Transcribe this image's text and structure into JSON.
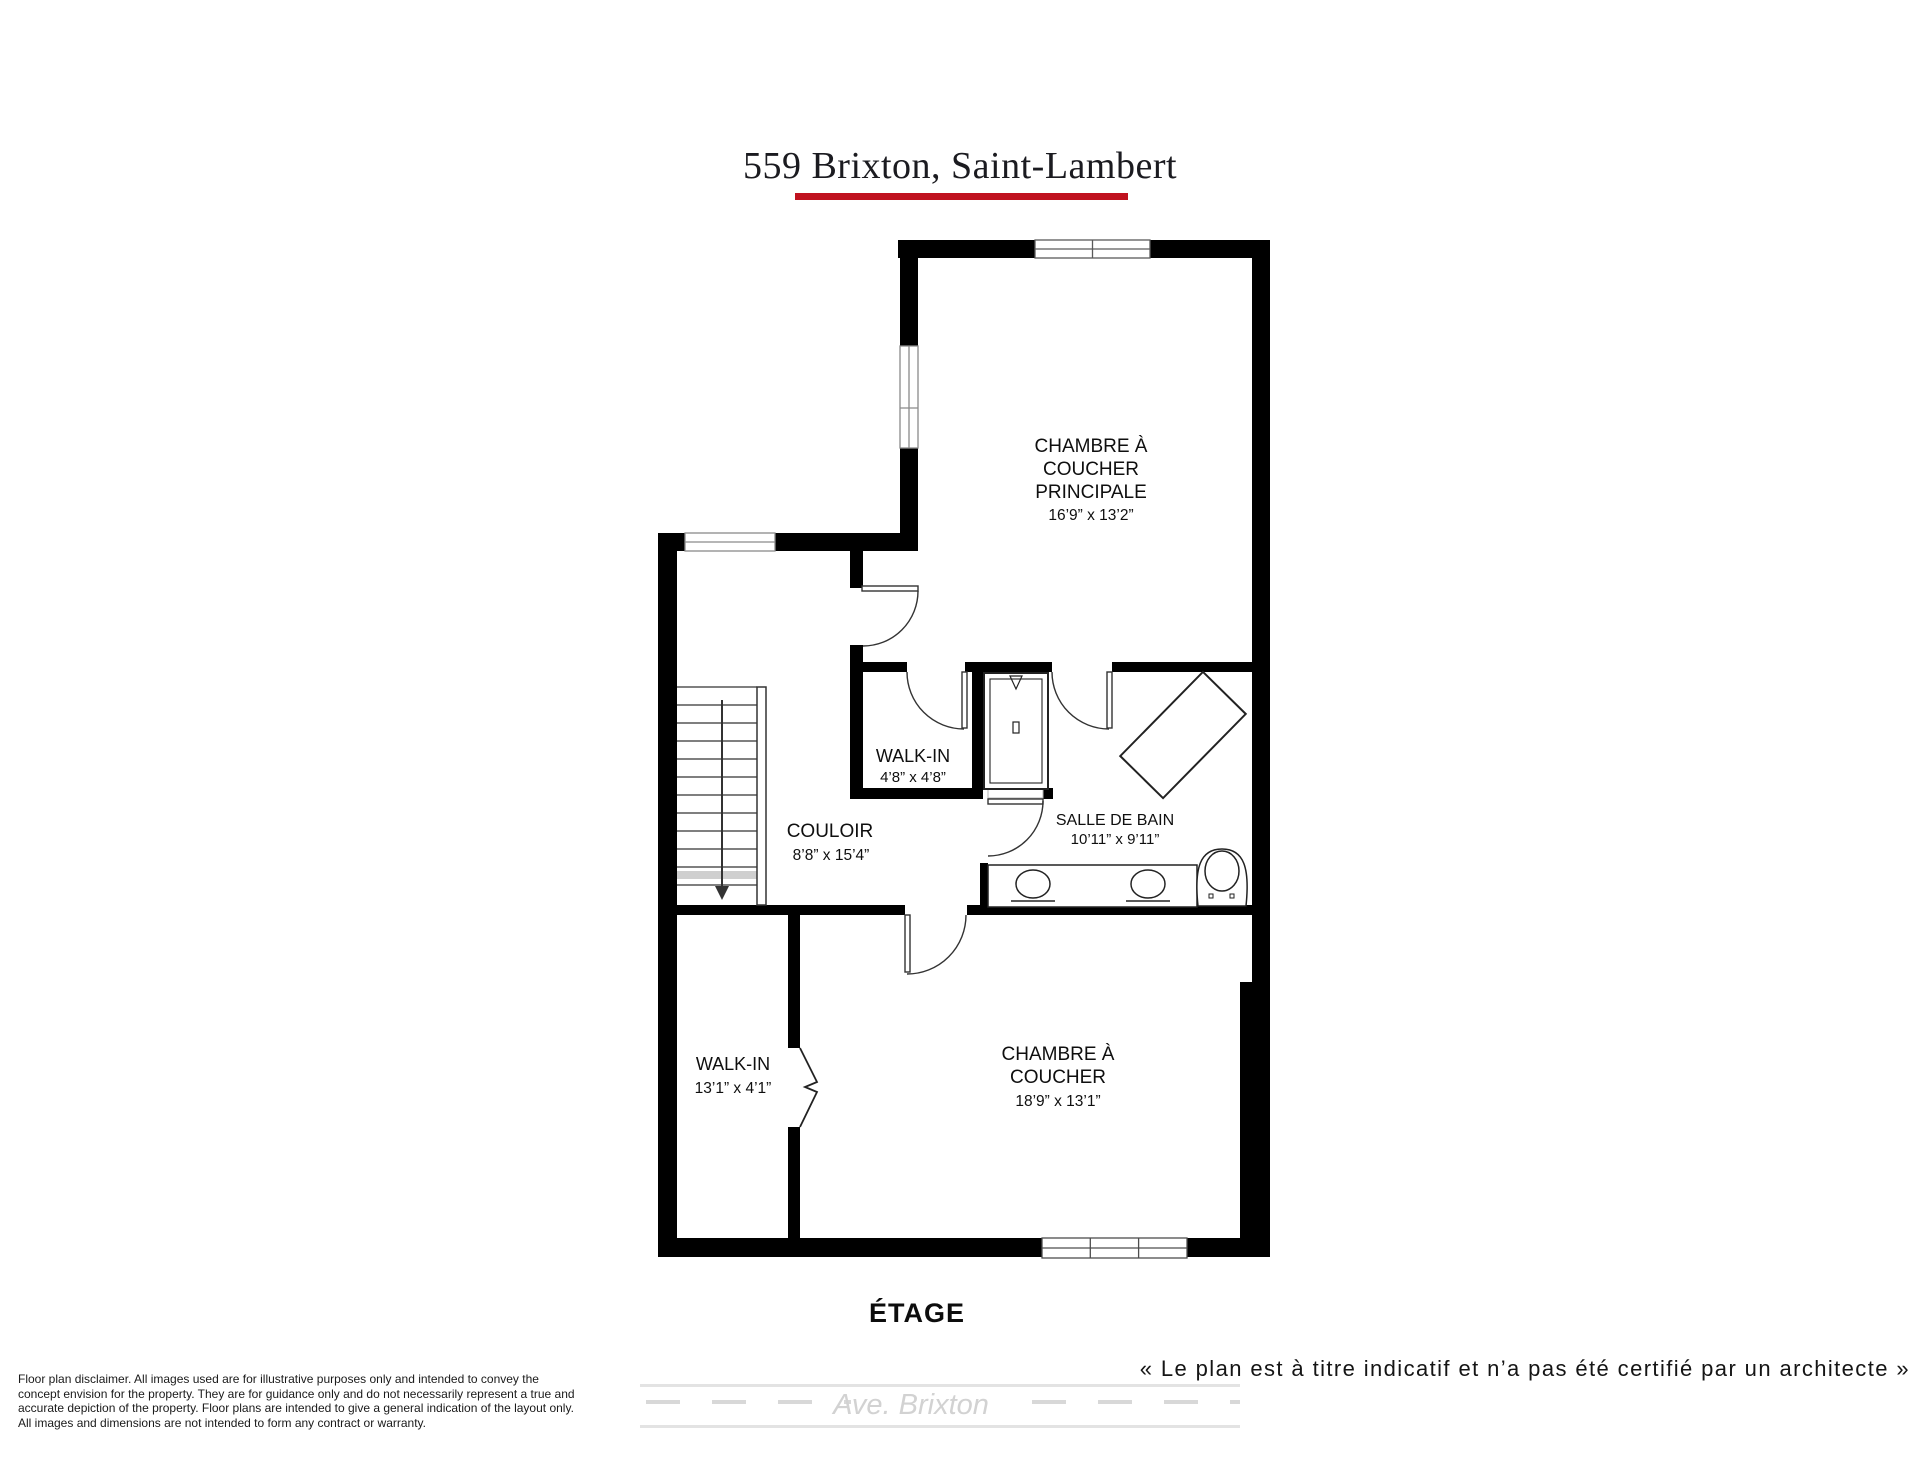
{
  "title": "559 Brixton, Saint-Lambert",
  "accent_color": "#c0121f",
  "floor_label": "ÉTAGE",
  "architect_note": "« Le plan est à titre indicatif et n’a pas été certifié par un architecte »",
  "street_label": "Ave. Brixton",
  "disclaimer_lines": {
    "l1": "Floor plan disclaimer. All images used are for illustrative purposes only and intended to convey the",
    "l2": "concept envision for the property. They are for guidance only and do not necessarily represent a true and",
    "l3": "accurate depiction of the property. Floor plans are intended to give a general indication of the layout only.",
    "l4": "All images and dimensions are not intended to form any contract or warranty."
  },
  "rooms": {
    "master_bedroom": {
      "line1": "CHAMBRE À",
      "line2": "COUCHER",
      "line3": "PRINCIPALE",
      "dims": "16’9” x 13’2”"
    },
    "walk_in_upper": {
      "line1": "WALK-IN",
      "dims": "4’8” x 4’8”"
    },
    "bathroom": {
      "line1": "SALLE DE BAIN",
      "dims": "10’11” x 9’11”"
    },
    "hallway": {
      "line1": "COULOIR",
      "dims": "8’8” x 15’4”"
    },
    "walk_in_lower": {
      "line1": "WALK-IN",
      "dims": "13’1” x 4’1”"
    },
    "bedroom": {
      "line1": "CHAMBRE À",
      "line2": "COUCHER",
      "dims": "18’9” x 13’1”"
    }
  }
}
